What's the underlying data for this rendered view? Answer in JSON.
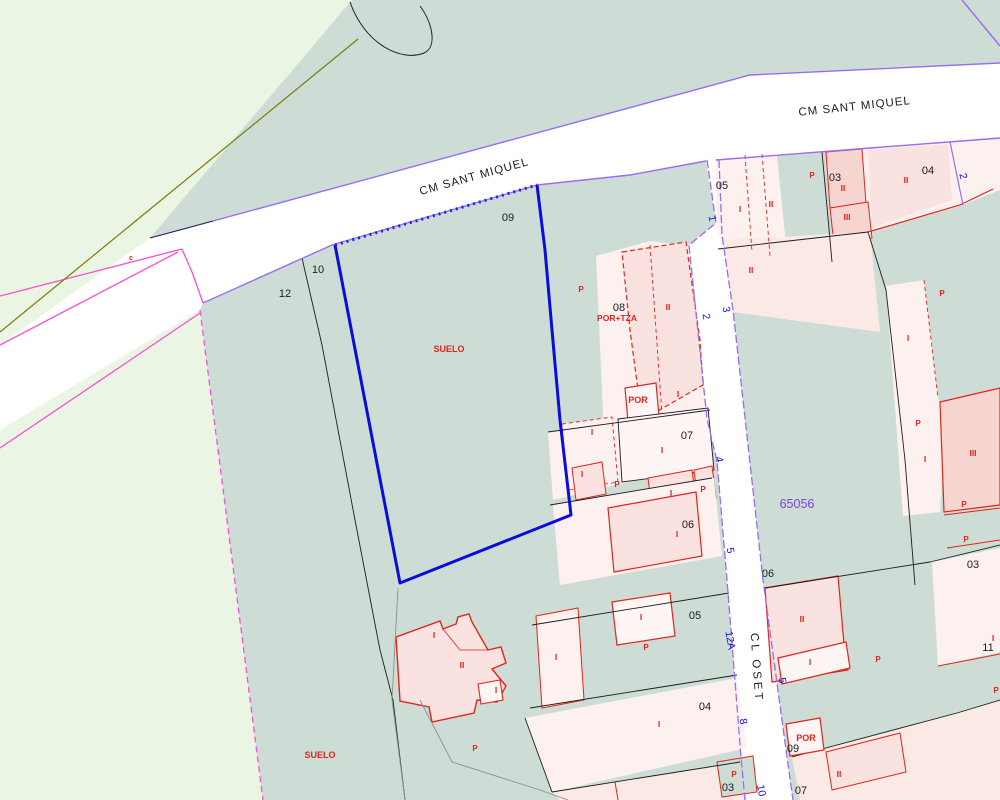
{
  "map": {
    "type": "cadastral-parcel-map",
    "colors": {
      "field_green": "#eaf5e4",
      "parcel_teal": "#cdddd5",
      "parcel_pink": "#fdf1ef",
      "parcel_pink_dark": "#fbe9e6",
      "building_pink": "#f9e2df",
      "building_pink_dark": "#f6d5d1",
      "building_white": "#fdf6f5",
      "road_white": "#ffffff",
      "line_red": "#e0241c",
      "line_black": "#1c1c1c",
      "line_gray": "#8f8f8f",
      "line_olive": "#7c7c00",
      "line_magenta": "#f94fd2",
      "line_purple": "#9a6cf0",
      "selected_blue": "#0b0bdc",
      "text_blue": "#1212e0",
      "text_purple": "#7b45d6"
    },
    "selected_parcel": {
      "number": "09",
      "classification": "SUELO"
    },
    "cadastral_reference": {
      "text": "65056",
      "x": 797,
      "y": 508
    },
    "street_names": [
      {
        "text": "CM SANT MIQUEL",
        "x": 475,
        "y": 180,
        "rot": -15.5,
        "spacing": 1
      },
      {
        "text": "CM SANT MIQUEL",
        "x": 855,
        "y": 110,
        "rot": -6,
        "spacing": 1
      },
      {
        "text": "CL OSET",
        "x": 753,
        "y": 668,
        "rot": 86,
        "spacing": 3
      }
    ],
    "parcel_numbers": [
      {
        "t": "12",
        "x": 285,
        "y": 297
      },
      {
        "t": "10",
        "x": 318,
        "y": 273
      },
      {
        "t": "09",
        "x": 508,
        "y": 221
      },
      {
        "t": "08",
        "x": 619,
        "y": 311
      },
      {
        "t": "07",
        "x": 687,
        "y": 439
      },
      {
        "t": "06",
        "x": 688,
        "y": 528
      },
      {
        "t": "05",
        "x": 695,
        "y": 619
      },
      {
        "t": "04",
        "x": 705,
        "y": 710
      },
      {
        "t": "03",
        "x": 728,
        "y": 791
      },
      {
        "t": "05",
        "x": 722,
        "y": 189
      },
      {
        "t": "03",
        "x": 835,
        "y": 181
      },
      {
        "t": "04",
        "x": 928,
        "y": 174
      },
      {
        "t": "06",
        "x": 768,
        "y": 577
      },
      {
        "t": "03",
        "x": 973,
        "y": 568
      },
      {
        "t": "11",
        "x": 988,
        "y": 651
      },
      {
        "t": "09",
        "x": 793,
        "y": 752
      },
      {
        "t": "07",
        "x": 801,
        "y": 794
      }
    ],
    "street_numbers": [
      {
        "t": "1",
        "x": 709,
        "y": 219,
        "rot": 80
      },
      {
        "t": "2",
        "x": 703,
        "y": 317,
        "rot": 80
      },
      {
        "t": "3",
        "x": 723,
        "y": 310,
        "rot": 80
      },
      {
        "t": "4",
        "x": 716,
        "y": 460,
        "rot": 80
      },
      {
        "t": "5",
        "x": 727,
        "y": 551,
        "rot": 80
      },
      {
        "t": "12A",
        "x": 727,
        "y": 641,
        "rot": 80
      },
      {
        "t": "8",
        "x": 740,
        "y": 722,
        "rot": 80
      },
      {
        "t": "5",
        "x": 779,
        "y": 681,
        "rot": 80
      },
      {
        "t": "10",
        "x": 758,
        "y": 791,
        "rot": 80
      },
      {
        "t": "2",
        "x": 960,
        "y": 177,
        "rot": 75
      }
    ],
    "building_annotations": [
      {
        "t": "SUELO",
        "x": 449,
        "y": 352,
        "s": 9
      },
      {
        "t": "SUELO",
        "x": 320,
        "y": 758,
        "s": 9
      },
      {
        "t": "POR+TZA",
        "x": 617,
        "y": 321,
        "s": 8.5
      },
      {
        "t": "POR",
        "x": 638,
        "y": 403,
        "s": 9
      },
      {
        "t": "POR",
        "x": 806,
        "y": 741,
        "s": 9
      },
      {
        "t": "c",
        "x": 131,
        "y": 260,
        "s": 7
      },
      {
        "t": "I",
        "x": 740,
        "y": 212,
        "s": 8.5
      },
      {
        "t": "I",
        "x": 662,
        "y": 453,
        "s": 8.5
      },
      {
        "t": "I",
        "x": 592,
        "y": 435,
        "s": 8.5
      },
      {
        "t": "I",
        "x": 582,
        "y": 477,
        "s": 8.5
      },
      {
        "t": "I",
        "x": 671,
        "y": 496,
        "s": 8.5
      },
      {
        "t": "I",
        "x": 677,
        "y": 537,
        "s": 8.5
      },
      {
        "t": "I",
        "x": 641,
        "y": 620,
        "s": 8.5
      },
      {
        "t": "I",
        "x": 556,
        "y": 660,
        "s": 8.5
      },
      {
        "t": "I",
        "x": 659,
        "y": 727,
        "s": 8.5
      },
      {
        "t": "I",
        "x": 434,
        "y": 638,
        "s": 8.5
      },
      {
        "t": "I",
        "x": 496,
        "y": 693,
        "s": 8.5
      },
      {
        "t": "I",
        "x": 678,
        "y": 397,
        "s": 8.5
      },
      {
        "t": "I",
        "x": 810,
        "y": 665,
        "s": 8.5
      },
      {
        "t": "I",
        "x": 908,
        "y": 341,
        "s": 8.5
      },
      {
        "t": "I",
        "x": 925,
        "y": 462,
        "s": 8.5
      },
      {
        "t": "I",
        "x": 993,
        "y": 641,
        "s": 8.5
      },
      {
        "t": "II",
        "x": 771,
        "y": 207,
        "s": 8.5
      },
      {
        "t": "II",
        "x": 843,
        "y": 191,
        "s": 8.5
      },
      {
        "t": "II",
        "x": 906,
        "y": 183,
        "s": 8.5
      },
      {
        "t": "II",
        "x": 668,
        "y": 310,
        "s": 8.5
      },
      {
        "t": "II",
        "x": 462,
        "y": 668,
        "s": 8.5
      },
      {
        "t": "II",
        "x": 751,
        "y": 273,
        "s": 8.5
      },
      {
        "t": "II",
        "x": 802,
        "y": 622,
        "s": 8.5
      },
      {
        "t": "II",
        "x": 839,
        "y": 777,
        "s": 8.5
      },
      {
        "t": "III",
        "x": 847,
        "y": 220,
        "s": 8.5
      },
      {
        "t": "III",
        "x": 973,
        "y": 456,
        "s": 8.5
      },
      {
        "t": "P",
        "x": 581,
        "y": 292,
        "s": 8
      },
      {
        "t": "P",
        "x": 475,
        "y": 751,
        "s": 8
      },
      {
        "t": "P",
        "x": 812,
        "y": 178,
        "s": 8
      },
      {
        "t": "P",
        "x": 878,
        "y": 662,
        "s": 8
      },
      {
        "t": "P",
        "x": 942,
        "y": 296,
        "s": 8
      },
      {
        "t": "P",
        "x": 918,
        "y": 426,
        "s": 8
      },
      {
        "t": "P",
        "x": 964,
        "y": 507,
        "s": 8
      },
      {
        "t": "P",
        "x": 966,
        "y": 542,
        "s": 8
      },
      {
        "t": "P",
        "x": 996,
        "y": 693,
        "s": 8
      },
      {
        "t": "P",
        "x": 734,
        "y": 777,
        "s": 8
      },
      {
        "t": "P",
        "x": 646,
        "y": 650,
        "s": 8
      },
      {
        "t": "P",
        "x": 617,
        "y": 487,
        "s": 8
      },
      {
        "t": "P",
        "x": 703,
        "y": 492,
        "s": 8
      }
    ]
  }
}
